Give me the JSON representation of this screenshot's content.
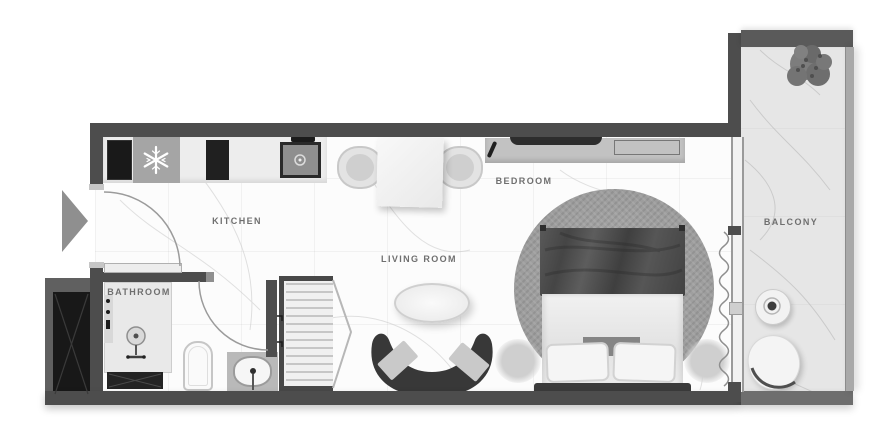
{
  "plan": {
    "rooms": {
      "kitchen": {
        "label": "KITCHEN"
      },
      "living_room": {
        "label": "LIVING ROOM"
      },
      "bedroom": {
        "label": "BEDROOM"
      },
      "bathroom": {
        "label": "BATHROOM"
      },
      "balcony": {
        "label": "BALCONY"
      }
    },
    "colors": {
      "wall": "#4d4d4d",
      "floor": "#fcfcfc",
      "balcony_floor": "#e6e6e6",
      "rug": "#9c9c9c",
      "sofa": "#383838",
      "shaft": "#181818",
      "entrance_arrow": "#8f8f8f",
      "label_text": "#6f6f6f"
    },
    "icons": [
      "entrance-arrow-icon",
      "door-swing-arc",
      "snowflake-fridge-icon",
      "oven-icon",
      "stove-icon",
      "kitchen-sink-icon",
      "dining-table",
      "dining-chair",
      "tv-icon",
      "console-table",
      "remote-icon",
      "round-rug",
      "double-bed",
      "pillow",
      "nightstand",
      "curved-sofa",
      "coffee-table",
      "wardrobe",
      "shower-icon",
      "toilet-icon",
      "bathroom-sink",
      "shaft-hatch",
      "curtain-wave",
      "sliding-glass-door",
      "balcony-table",
      "balcony-chair",
      "plant-icon",
      "balcony-railing"
    ]
  }
}
